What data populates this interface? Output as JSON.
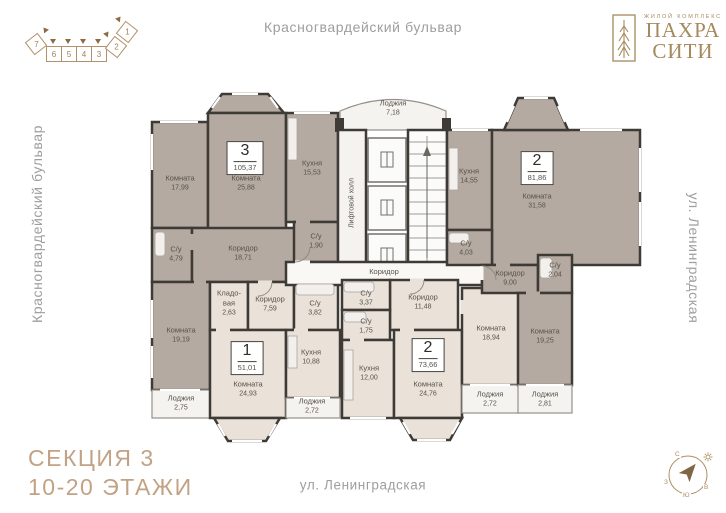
{
  "brand": {
    "type_label": "ЖИЛОЙ КОМПЛЕКС",
    "name_line1": "ПАХРА",
    "name_line2": "СИТИ"
  },
  "streets": {
    "top": "Красногвардейский бульвар",
    "left": "Красногвардейский бульвар",
    "right": "ул. Ленинградская",
    "bottom": "ул. Ленинградская"
  },
  "section_info": {
    "line1": "СЕКЦИЯ 3",
    "line2": "10-20 ЭТАЖИ"
  },
  "section_diagram": {
    "sections": [
      "7",
      "6",
      "5",
      "4",
      "3",
      "2",
      "1"
    ]
  },
  "compass": {
    "north": "С",
    "east": "В",
    "south": "Ю",
    "west": "З"
  },
  "apartments": [
    {
      "number": "3",
      "total_area": "105,37"
    },
    {
      "number": "2",
      "total_area": "81,86"
    },
    {
      "number": "1",
      "total_area": "51,01"
    },
    {
      "number": "2",
      "total_area": "73,66"
    }
  ],
  "rooms": [
    {
      "name": "Комната",
      "area": "17,99"
    },
    {
      "name": "Комната",
      "area": "25,88"
    },
    {
      "name": "Кухня",
      "area": "15,53"
    },
    {
      "name": "С/у",
      "area": "4,79"
    },
    {
      "name": "Коридор",
      "area": "18,71"
    },
    {
      "name": "С/у",
      "area": "1,90"
    },
    {
      "name": "Комната",
      "area": "19,19"
    },
    {
      "name": "Лоджия",
      "area": "2,75"
    },
    {
      "name": "Кухня",
      "area": "14,55"
    },
    {
      "name": "Комната",
      "area": "31,58"
    },
    {
      "name": "С/у",
      "area": "4,03"
    },
    {
      "name": "Коридор",
      "area": "9,00"
    },
    {
      "name": "С/у",
      "area": "2,04"
    },
    {
      "name": "Комната",
      "area": "19,25"
    },
    {
      "name": "Лоджия",
      "area": "2,81"
    },
    {
      "name": "Кладо-вая",
      "area": "2,63"
    },
    {
      "name": "Коридор",
      "area": "7,59"
    },
    {
      "name": "С/у",
      "area": "3,82"
    },
    {
      "name": "Комната",
      "area": "24,93"
    },
    {
      "name": "Кухня",
      "area": "10,88"
    },
    {
      "name": "Лоджия",
      "area": "2,72"
    },
    {
      "name": "С/у",
      "area": "3,37"
    },
    {
      "name": "С/у",
      "area": "1,75"
    },
    {
      "name": "Коридор",
      "area": "11,48"
    },
    {
      "name": "Кухня",
      "area": "12,00"
    },
    {
      "name": "Комната",
      "area": "24,76"
    },
    {
      "name": "Комната",
      "area": "18,94"
    },
    {
      "name": "Лоджия",
      "area": "2,72"
    },
    {
      "name": "Лоджия",
      "area": "7,18"
    },
    {
      "name": "Коридор"
    },
    {
      "name": "Лифтовой холл"
    }
  ],
  "colors": {
    "accent": "#a5895c",
    "section_text": "#c2a284",
    "wall": "#3e3b37",
    "room_dark": "#b5aaa1",
    "room_light": "#eae2d9",
    "street_text": "#9e9e9e"
  }
}
